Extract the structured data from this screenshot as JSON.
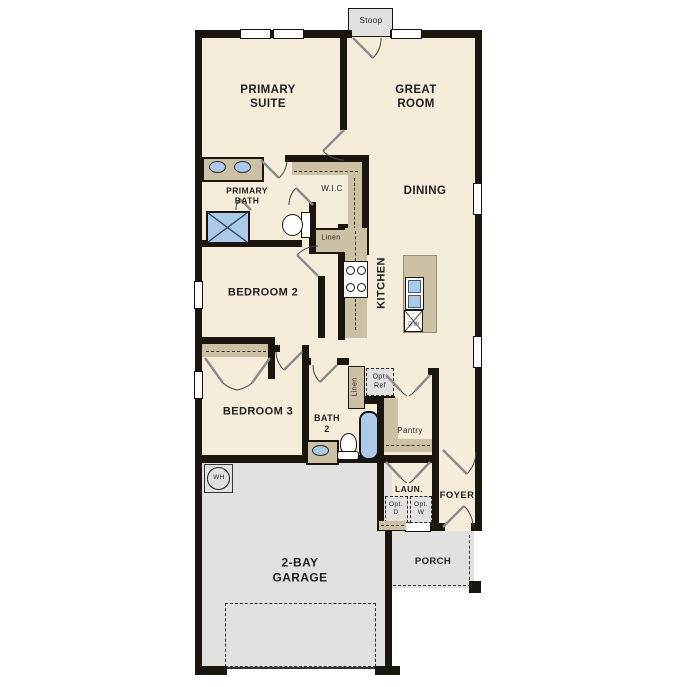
{
  "colors": {
    "wall": "#1b1510",
    "floor": "#f5ecda",
    "cabinet_tan": "#ccc0a5",
    "fixture_blue": "#abc9e9",
    "concrete_gray": "#e2e1df",
    "background": "#ffffff"
  },
  "labels": {
    "stoop": "Stoop",
    "primary_suite": "PRIMARY\nSUITE",
    "great_room": "GREAT\nROOM",
    "primary_bath": "PRIMARY\nBATH",
    "wic": "W.I.C",
    "dining": "DINING",
    "linen_wic": "Linen",
    "kitchen": "KITCHEN",
    "dishwasher": "DW",
    "bedroom2": "BEDROOM 2",
    "bedroom3": "BEDROOM 3",
    "bath2": "BATH\n2",
    "linen_bath2": "Linen",
    "opt_ref": "Opt.\nRef",
    "pantry": "Pantry",
    "laundry": "LAUN.",
    "opt_dryer": "Opt.\nD",
    "opt_washer": "Opt.\nW",
    "foyer": "FOYER",
    "water_heater": "WH",
    "garage": "2-BAY\nGARAGE",
    "porch": "PORCH"
  }
}
